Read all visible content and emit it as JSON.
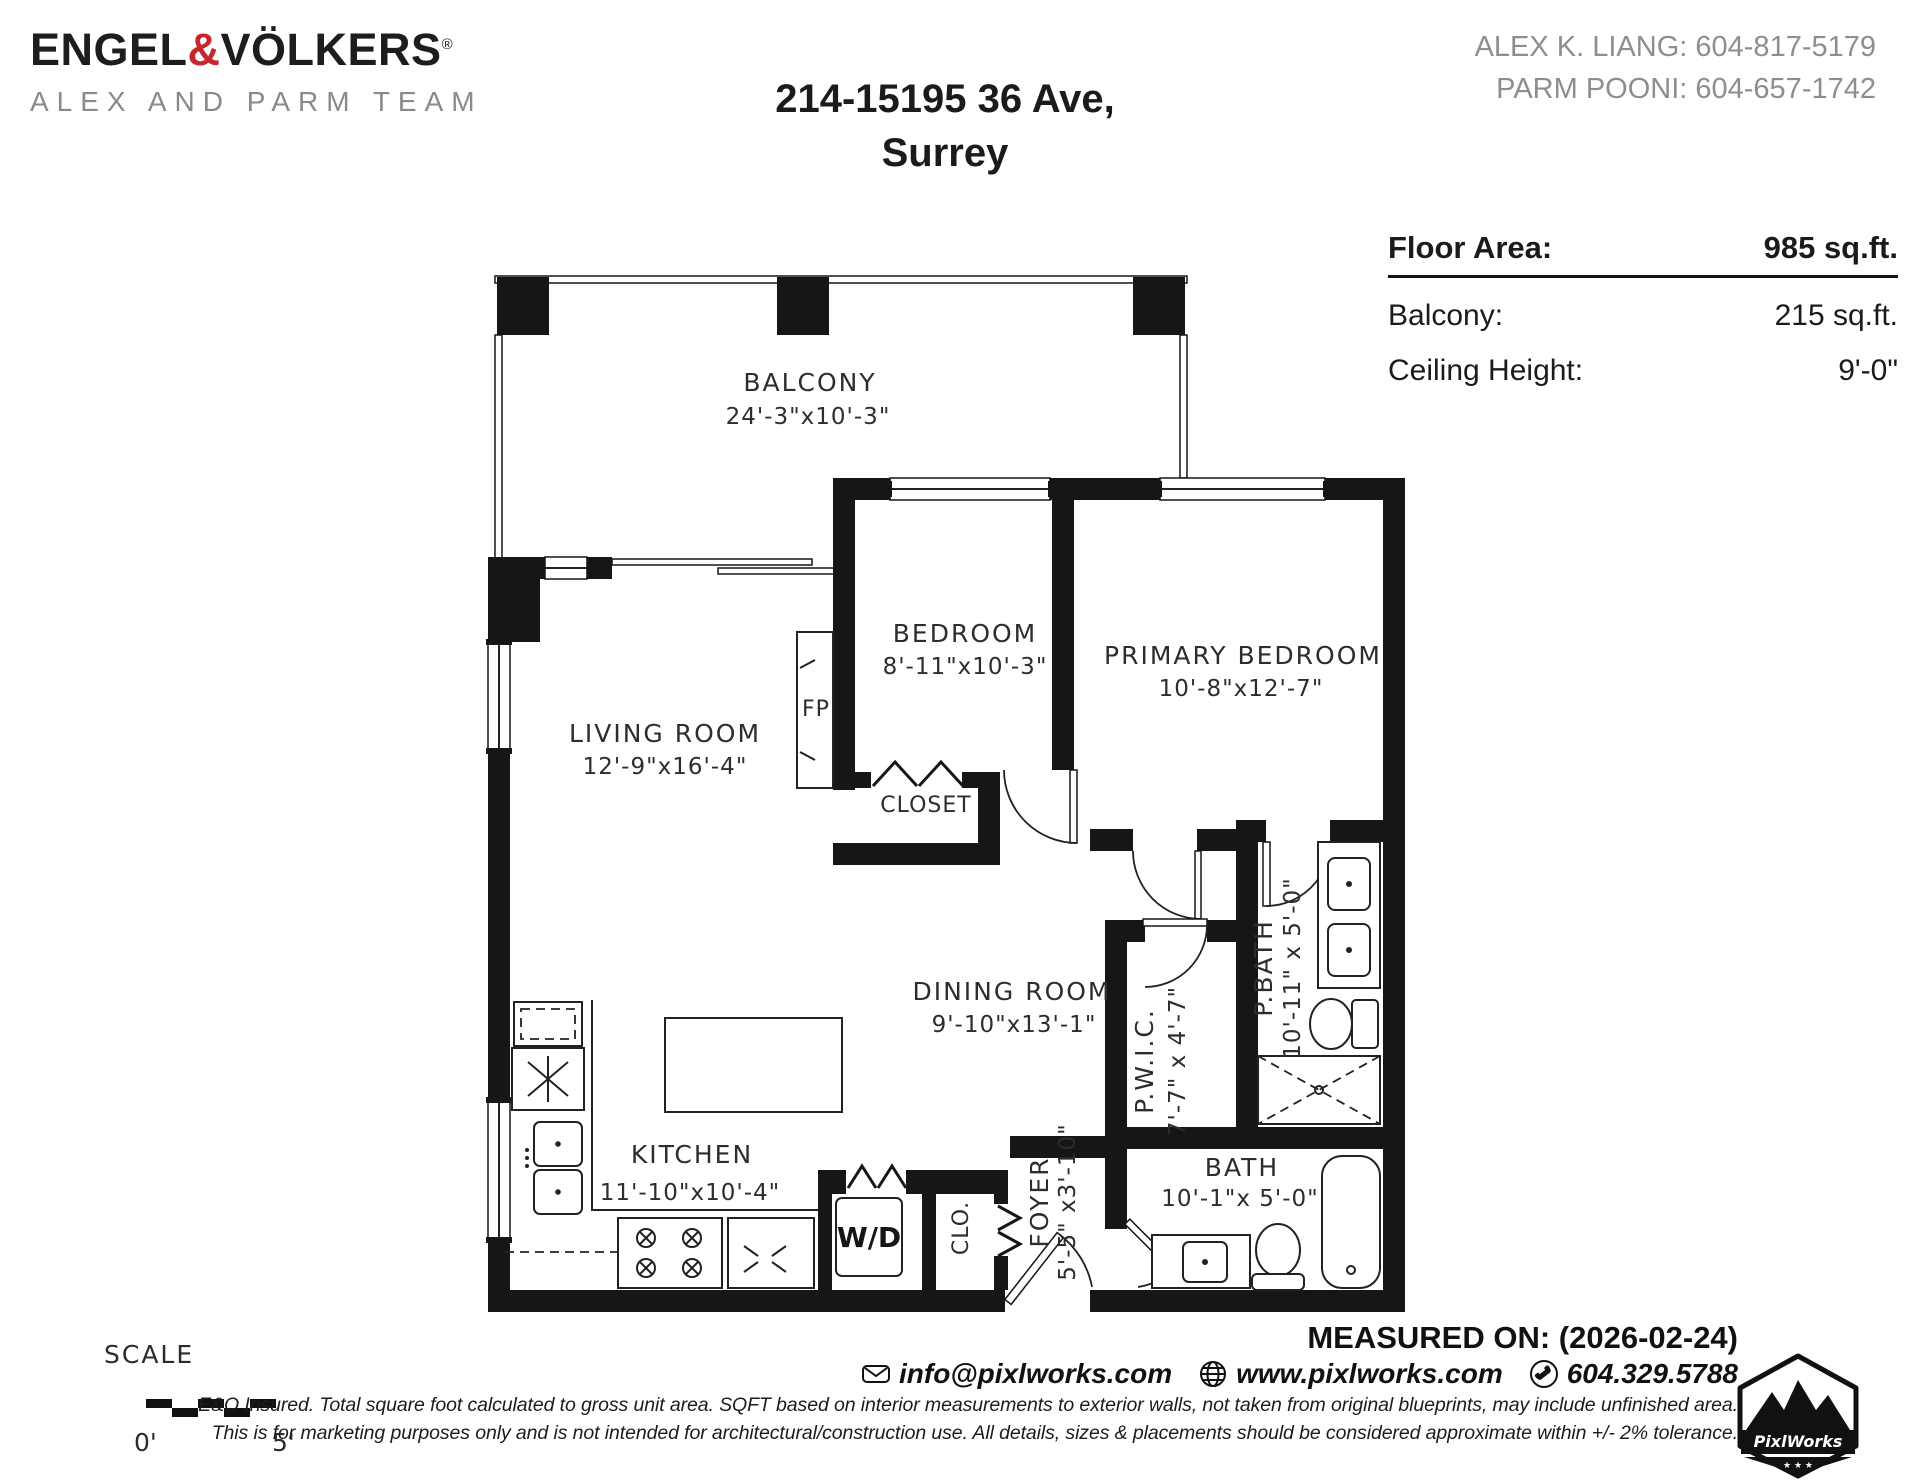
{
  "brand": {
    "logo_engel": "ENGEL",
    "logo_amp": "&",
    "logo_volkers": "VÖLKERS",
    "logo_reg": "®",
    "team": "ALEX AND PARM TEAM",
    "accent_red": "#c8252c"
  },
  "header": {
    "address_line1": "214-15195 36 Ave,",
    "address_line2": "Surrey",
    "agent1": "ALEX K. LIANG: 604-817-5179",
    "agent2": "PARM POONI: 604-657-1742"
  },
  "summary": {
    "floor_area_label": "Floor Area:",
    "floor_area_value": "985 sq.ft.",
    "balcony_label": "Balcony:",
    "balcony_value": "215 sq.ft.",
    "ceiling_label": "Ceiling Height:",
    "ceiling_value": "9'-0\""
  },
  "rooms": {
    "balcony": {
      "name": "BALCONY",
      "dims": "24'-3\"x10'-3\""
    },
    "bedroom": {
      "name": "BEDROOM",
      "dims": "8'-11\"x10'-3\""
    },
    "primary": {
      "name": "PRIMARY BEDROOM",
      "dims": "10'-8\"x12'-7\""
    },
    "living": {
      "name": "LIVING ROOM",
      "dims": "12'-9\"x16'-4\""
    },
    "dining": {
      "name": "DINING ROOM",
      "dims": "9'-10\"x13'-1\""
    },
    "kitchen": {
      "name": "KITCHEN",
      "dims": "11'-10\"x10'-4\""
    },
    "closet": {
      "name": "CLOSET"
    },
    "pwic": {
      "name": "P.W.I.C.",
      "dims": "7'-7\" x 4'-7\""
    },
    "pbath": {
      "name": "P.BATH",
      "dims": "10'-11\" x 5'-0\""
    },
    "bath": {
      "name": "BATH",
      "dims": "10'-1\"x 5'-0\""
    },
    "foyer": {
      "name": "FOYER",
      "dims": "5'-5\" x3'-10\""
    }
  },
  "fixtures": {
    "fireplace": "FP",
    "washer_dryer": "W/D",
    "closet_small": "CLO."
  },
  "scale": {
    "label": "SCALE",
    "start": "0'",
    "end": "5'"
  },
  "footer": {
    "measured": "MEASURED ON: (2026-02-24)",
    "email": "info@pixlworks.com",
    "website": "www.pixlworks.com",
    "phone": "604.329.5788",
    "disclaimer1": "E&O Insured.  Total square foot calculated to gross unit area. SQFT based on interior measurements to exterior walls, not taken from original blueprints, may include unfinished area.",
    "disclaimer2": "This is for marketing purposes only and is not intended for architectural/construction use.  All details, sizes & placements should be considered approximate within +/- 2%  tolerance.",
    "logo_text": "PixlWorks",
    "logo_stars": "★ ★ ★"
  }
}
